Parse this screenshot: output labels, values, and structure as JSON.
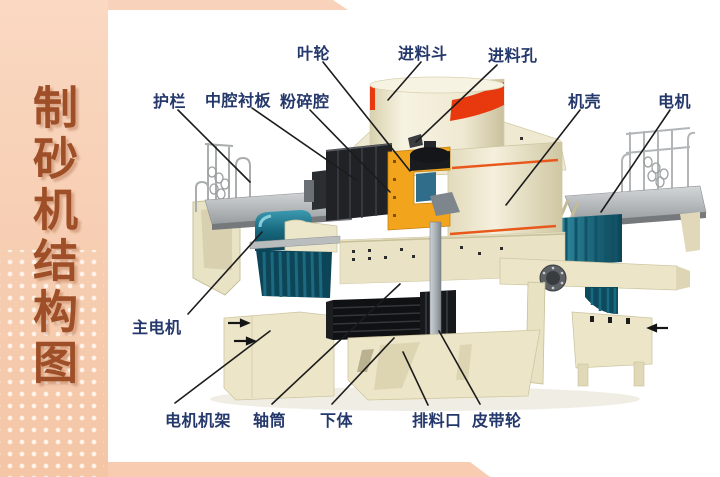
{
  "sidebar": {
    "title": "制砂机结构图"
  },
  "diagram": {
    "labels": [
      {
        "id": "impeller",
        "text": "叶轮"
      },
      {
        "id": "feed-hopper",
        "text": "进料斗"
      },
      {
        "id": "feed-hole",
        "text": "进料孔"
      },
      {
        "id": "guardrail",
        "text": "护栏"
      },
      {
        "id": "cavity-liner",
        "text": "中腔衬板"
      },
      {
        "id": "crushing-chamber",
        "text": "粉碎腔"
      },
      {
        "id": "casing",
        "text": "机壳"
      },
      {
        "id": "motor",
        "text": "电机"
      },
      {
        "id": "main-motor",
        "text": "主电机"
      },
      {
        "id": "motor-frame",
        "text": "电机机架"
      },
      {
        "id": "shaft-tube",
        "text": "轴筒"
      },
      {
        "id": "lower-body",
        "text": "下体"
      },
      {
        "id": "discharge-port",
        "text": "排料口"
      },
      {
        "id": "belt-pulley",
        "text": "皮带轮"
      }
    ],
    "colors": {
      "label_text": "#25386b",
      "leader_line": "#1c1c1c",
      "hopper_band_red": "#e8380d",
      "impeller_orange": "#f3a41d",
      "motor_teal": "#15607a",
      "machine_cream": "#ece5c8",
      "deck_gray": "#a7abad",
      "sidebar_peach": "#f6cbac",
      "sidebar_title_brown": "#9e4f28"
    }
  }
}
